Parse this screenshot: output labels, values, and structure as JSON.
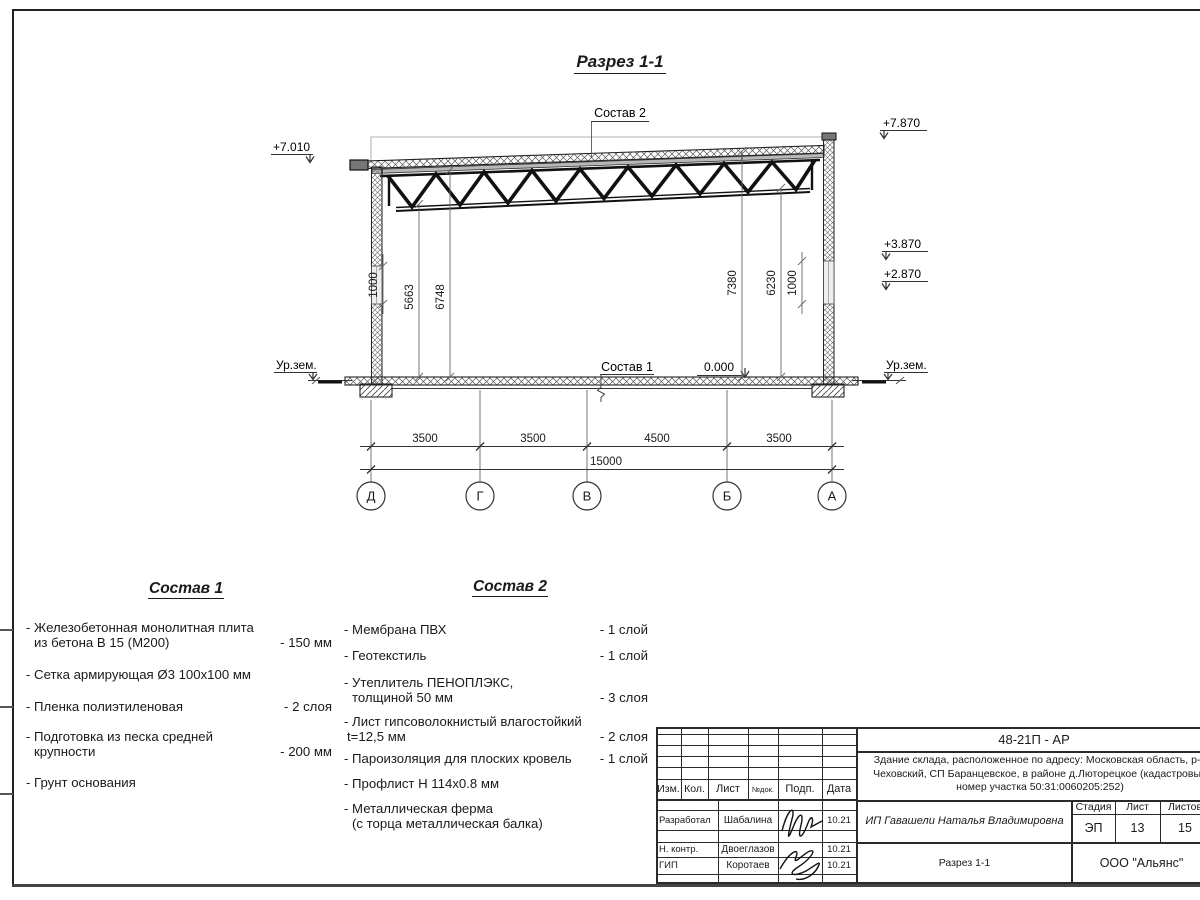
{
  "drawing": {
    "section_title": "Разрез 1-1",
    "labels": {
      "comp2": "Состав 2",
      "comp1": "Состав 1"
    },
    "elevations": {
      "left_top": "+7.010",
      "right_top": "+7.870",
      "right_mid": "+3.870",
      "right_low": "+2.870",
      "zero": "0.000",
      "ground_left": "Ур.зем.",
      "ground_right": "Ур.зем."
    },
    "vdims": {
      "left_band": "1000",
      "left_inner": "5663",
      "left_outer": "6748",
      "right_inner": "7380",
      "right_mid": "6230",
      "right_band": "1000"
    },
    "hdims": {
      "d1": "3500",
      "d2": "3500",
      "d3": "4500",
      "d4": "3500",
      "total": "15000"
    },
    "axes": {
      "a1": "Д",
      "a2": "Г",
      "a3": "В",
      "a4": "Б",
      "a5": "А"
    }
  },
  "comp1": {
    "title": "Состав 1",
    "items": [
      {
        "line1": "- Железобетонная  монолитная плита",
        "line2": "из бетона В 15 (М200)",
        "value": "- 150 мм"
      },
      {
        "line1": "- Сетка армирующая Ø3 100х100 мм",
        "line2": "",
        "value": ""
      },
      {
        "line1": "- Пленка полиэтиленовая",
        "line2": "",
        "value": "-  2 слоя"
      },
      {
        "line1": "- Подготовка из песка средней",
        "line2": "крупности",
        "value": "- 200 мм"
      },
      {
        "line1": "- Грунт основания",
        "line2": "",
        "value": ""
      }
    ]
  },
  "comp2": {
    "title": "Состав 2",
    "items": [
      {
        "line1": "- Мембрана ПВХ",
        "line2": "",
        "value": "- 1 слой"
      },
      {
        "line1": "- Геотекстиль",
        "line2": "",
        "value": "- 1 слой"
      },
      {
        "line1": "- Утеплитель ПЕНОПЛЭКС,",
        "line2": "толщиной 50 мм",
        "value": "- 3 слоя"
      },
      {
        "line1": "- Лист гипсоволокнистый влагостойкий",
        "line2": "t=12,5 мм",
        "value": "- 2 слоя"
      },
      {
        "line1": "- Пароизоляция для плоских кровель",
        "line2": "",
        "value": "- 1 слой"
      },
      {
        "line1": "- Профлист Н 114х0.8 мм",
        "line2": "",
        "value": ""
      },
      {
        "line1": "- Металлическая ферма",
        "line2": "(с торца металлическая балка)",
        "value": ""
      }
    ]
  },
  "titleblock": {
    "doc_code": "48-21П - АР",
    "project_line1": "Здание склада, расположенное по адресу: Московская область, р-н",
    "project_line2": "Чеховский, СП Баранцевское, в районе д.Люторецкое  (кадастровый",
    "project_line3": "номер участка 50:31:0060205:252)",
    "client": "ИП Гавашели Наталья Владимировна",
    "sheet_name": "Разрез 1-1",
    "company": "ООО \"Альянс\"",
    "cols": {
      "izm": "Изм.",
      "kol": "Кол.",
      "list": "Лист",
      "ndok": "№док.",
      "podp": "Подп.",
      "data": "Дата"
    },
    "stage_label": "Стадия",
    "sheet_label": "Лист",
    "sheets_label": "Листов",
    "stage": "ЭП",
    "sheet_no": "13",
    "sheets_total": "15",
    "rows": [
      {
        "role": "Разработал",
        "name": "Шабалина",
        "date": "10.21"
      },
      {
        "role": "Н. контр.",
        "name": "Двоеглазов",
        "date": "10.21"
      },
      {
        "role": "ГИП",
        "name": "Коротаев",
        "date": "10.21"
      }
    ]
  }
}
